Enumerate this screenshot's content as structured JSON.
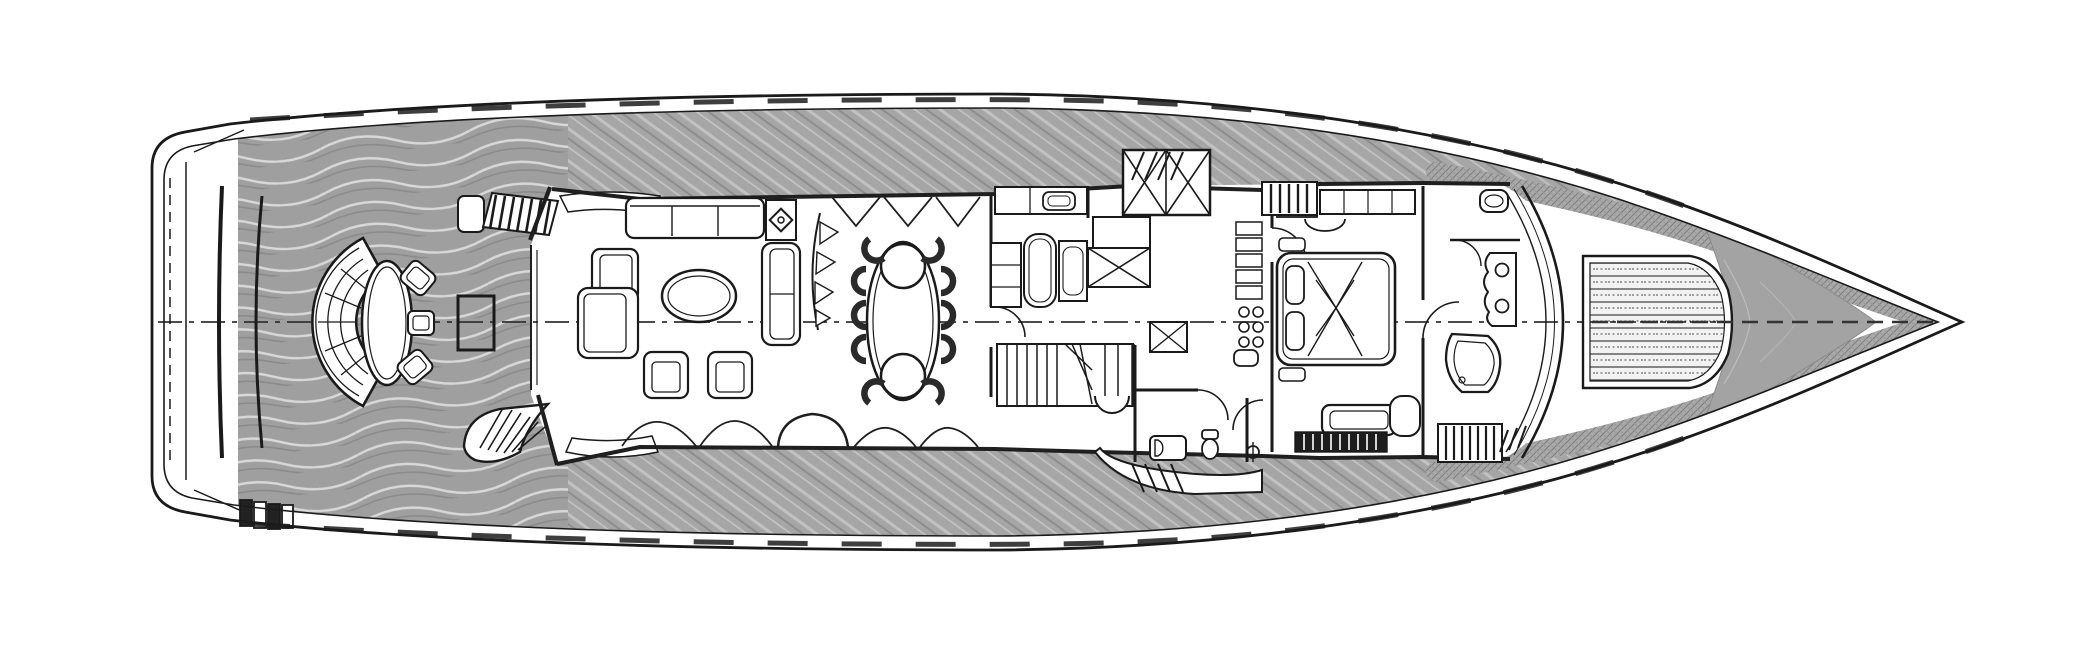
{
  "meta": {
    "title": "Motor yacht general arrangement - main deck floor plan",
    "view": "top-down plan drawing, black line art with grey teak decks",
    "orientation": "bow to the right, stern to the left",
    "visible_text": ""
  },
  "colors": {
    "background": "#ffffff",
    "ink": "#1a1a1a",
    "teak_deck": "#a6a6a6",
    "teak_seam_light": "#c2c2c2",
    "teak_seam_dark": "#8d8d8d",
    "aft_deck_base": "#9f9f9f",
    "aft_grain_light": "#d8d8d8",
    "aft_grain_dark": "#8a8a8a",
    "foredeck_shield": "#a3a3a3",
    "hatch_band_base": "#a9a9a9",
    "hatch_band_line": "#7d7d7d",
    "sunpad_slat": "#3e3e3e",
    "interior_floor": "#ffffff",
    "centerline": "#333333"
  },
  "areas": [
    {
      "id": "swim-platform",
      "label": "Transom and swim platform with stern steps"
    },
    {
      "id": "aft-deck",
      "label": "Aft deck with wavy teak decking and side boarding stairs"
    },
    {
      "id": "aft-seating",
      "label": "Curved fan bench seating, oval cocktail table, three stools and square service table"
    },
    {
      "id": "salon",
      "label": "Main salon: three-seat sofa, L-sofa, two armchairs, oval coffee table, sideboard with decor"
    },
    {
      "id": "dining",
      "label": "Dining area: oval table with two round end chairs and eight side chairs"
    },
    {
      "id": "galley",
      "label": "Galley and lobby: counters, sink, appliances, hatch boxes, pantry shelves and cooktop"
    },
    {
      "id": "stairwell",
      "label": "Main staircase down with winder treads and round landing step"
    },
    {
      "id": "day-head",
      "label": "Day head with wash basin and WC"
    },
    {
      "id": "master-stateroom",
      "label": "Master stateroom: double bed with pillows and throw, dresser, TV bench, side door"
    },
    {
      "id": "master-bathroom",
      "label": "Master bathroom: bathtub, twin-basin vanity, WC compartment, companionway steps"
    },
    {
      "id": "windshield",
      "label": "Raked curved windshield at front of superstructure"
    },
    {
      "id": "foredeck-sunpad",
      "label": "Slatted foredeck sun pad"
    },
    {
      "id": "bow-deck",
      "label": "Grey bow / anchor deck tapering to the stem"
    },
    {
      "id": "side-decks",
      "label": "Port and starboard teak side decks with steps and gunwale fittings"
    }
  ]
}
